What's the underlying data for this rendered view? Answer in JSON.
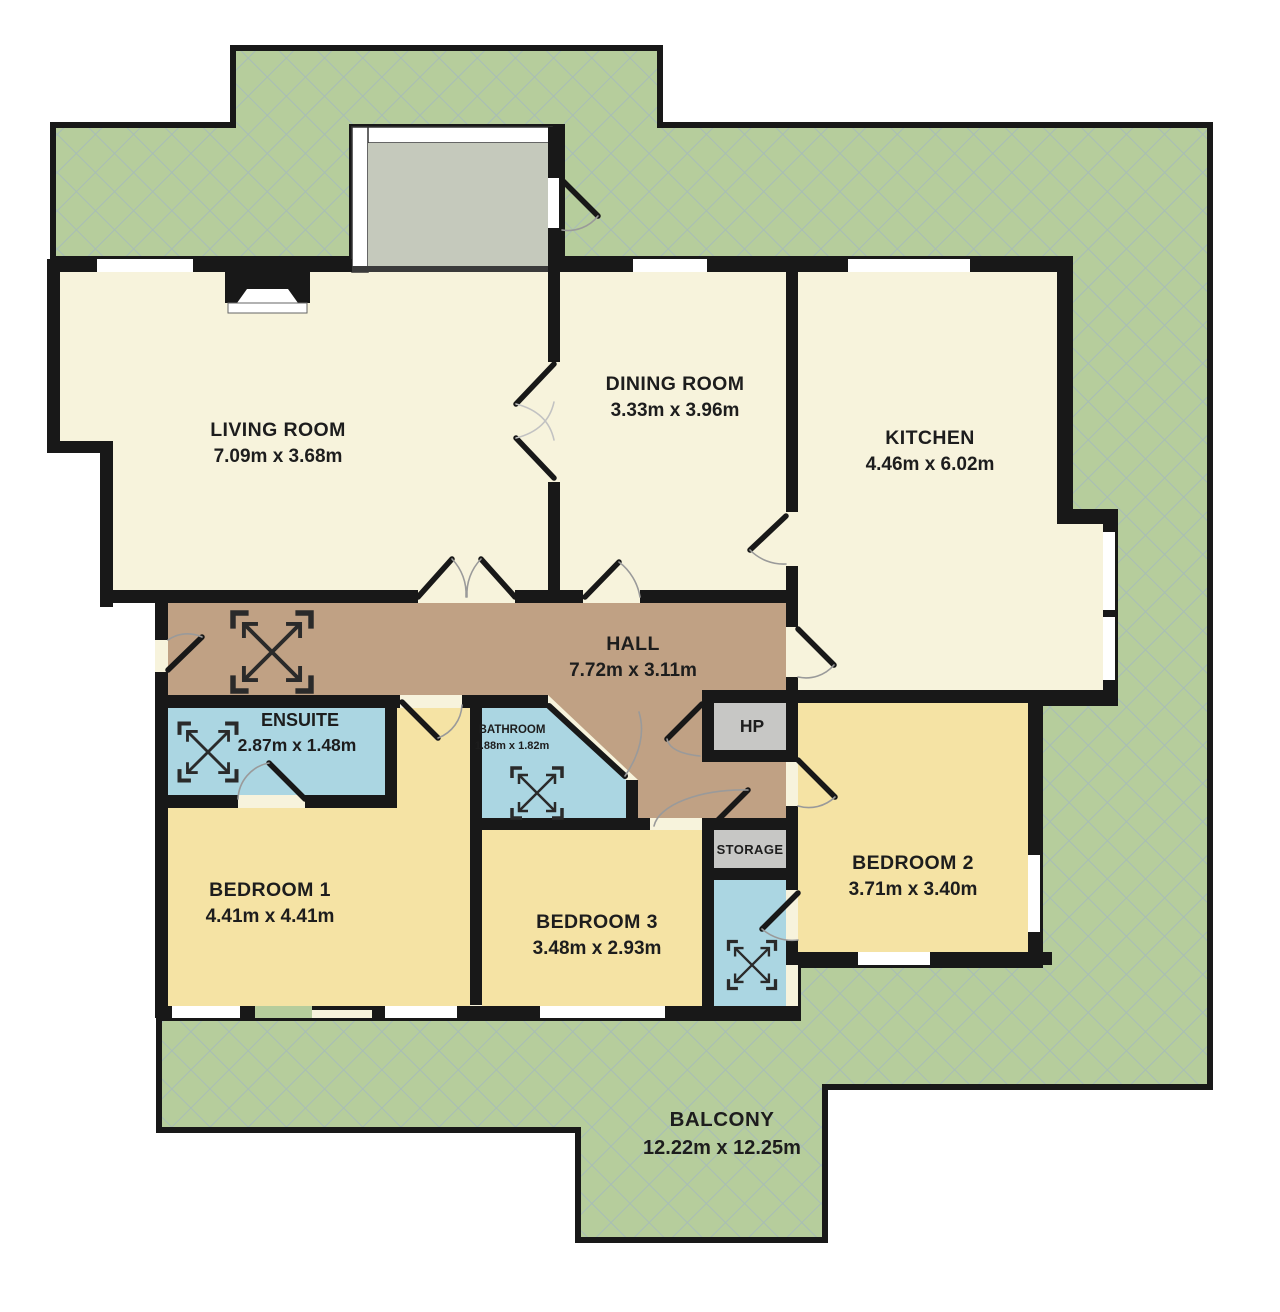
{
  "floorplan": {
    "rooms": {
      "living": {
        "name": "LIVING ROOM",
        "dims": "7.09m x 3.68m"
      },
      "dining": {
        "name": "DINING ROOM",
        "dims": "3.33m x 3.96m"
      },
      "kitchen": {
        "name": "KITCHEN",
        "dims": "4.46m x 6.02m"
      },
      "hall": {
        "name": "HALL",
        "dims": "7.72m x 3.11m"
      },
      "ensuite": {
        "name": "ENSUITE",
        "dims": "2.87m x 1.48m"
      },
      "bathroom": {
        "name": "BATHROOM",
        "dims": "1.88m x 1.82m"
      },
      "hp": {
        "name": "HP"
      },
      "storage": {
        "name": "STORAGE"
      },
      "bedroom1": {
        "name": "BEDROOM 1",
        "dims": "4.41m x 4.41m"
      },
      "bedroom2": {
        "name": "BEDROOM 2",
        "dims": "3.71m x 3.40m"
      },
      "bedroom3": {
        "name": "BEDROOM 3",
        "dims": "3.48m x 2.93m"
      },
      "balcony": {
        "name": "BALCONY",
        "dims": "12.22m x 12.25m"
      }
    },
    "colors": {
      "balcony_green": "#b6cd9c",
      "hatch_line": "#a0b4c4",
      "room_cream": "#f7f3dc",
      "bedroom_yellow": "#f5e3a4",
      "bath_blue": "#abd6e2",
      "hall_brown": "#c0a184",
      "utility_gray": "#c7c7c5",
      "porch_gray": "#c5c9bc",
      "wall_black": "#181818"
    }
  }
}
